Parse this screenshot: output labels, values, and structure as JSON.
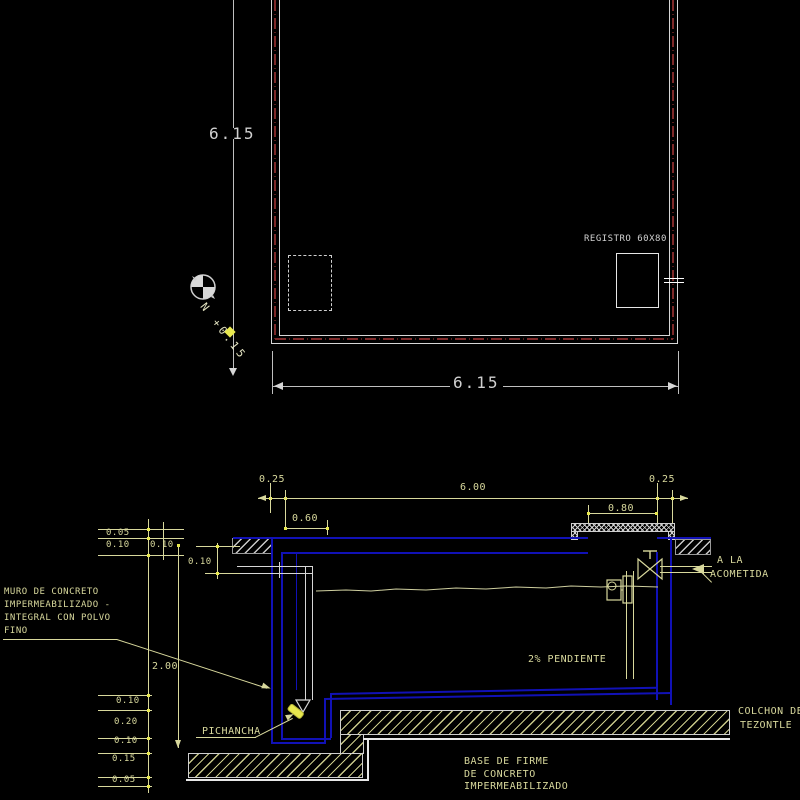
{
  "drawing": {
    "plan": {
      "dim_side": "6.15",
      "dim_bottom": "6.15",
      "registro_label": "REGISTRO 60X80",
      "north_letter": "N",
      "north_level": "+0.15"
    },
    "section": {
      "dim_top_left": "0.25",
      "dim_top_span": "6.00",
      "dim_top_right": "0.25",
      "dim_opening": "0.80",
      "dim_inset": "0.60",
      "dim_slab_a": "0.05",
      "dim_slab_b": "0.10",
      "dim_slab_c": "0.10",
      "dim_inlet_drop": "0.10",
      "dim_depth": "2.00",
      "dim_floor_a": "0.10",
      "dim_floor_b": "0.20",
      "dim_floor_c": "0.10",
      "dim_base_a": "0.15",
      "dim_base_b": "0.05",
      "muro_line1": "MURO DE CONCRETO",
      "muro_line2": "IMPERMEABILIZADO -",
      "muro_line3": "INTEGRAL CON POLVO",
      "muro_line4": "FINO",
      "pichancha_label": "PICHANCHA",
      "pendiente_label": "2% PENDIENTE",
      "acometida_line1": "A LA",
      "acometida_line2": "ACOMETIDA",
      "colchon_line1": "COLCHON DE",
      "colchon_line2": "TEZONTLE",
      "base_line1": "BASE DE FIRME",
      "base_line2": "DE CONCRETO",
      "base_line3": "IMPERMEABILIZADO"
    },
    "colors": {
      "background": "#000000",
      "line_white": "#d6d6d6",
      "wall_blue": "#1111b6",
      "centerline_red": "#7e2929",
      "text_khaki": "#d8d89c",
      "marker_yellow": "#e8e84e"
    }
  }
}
